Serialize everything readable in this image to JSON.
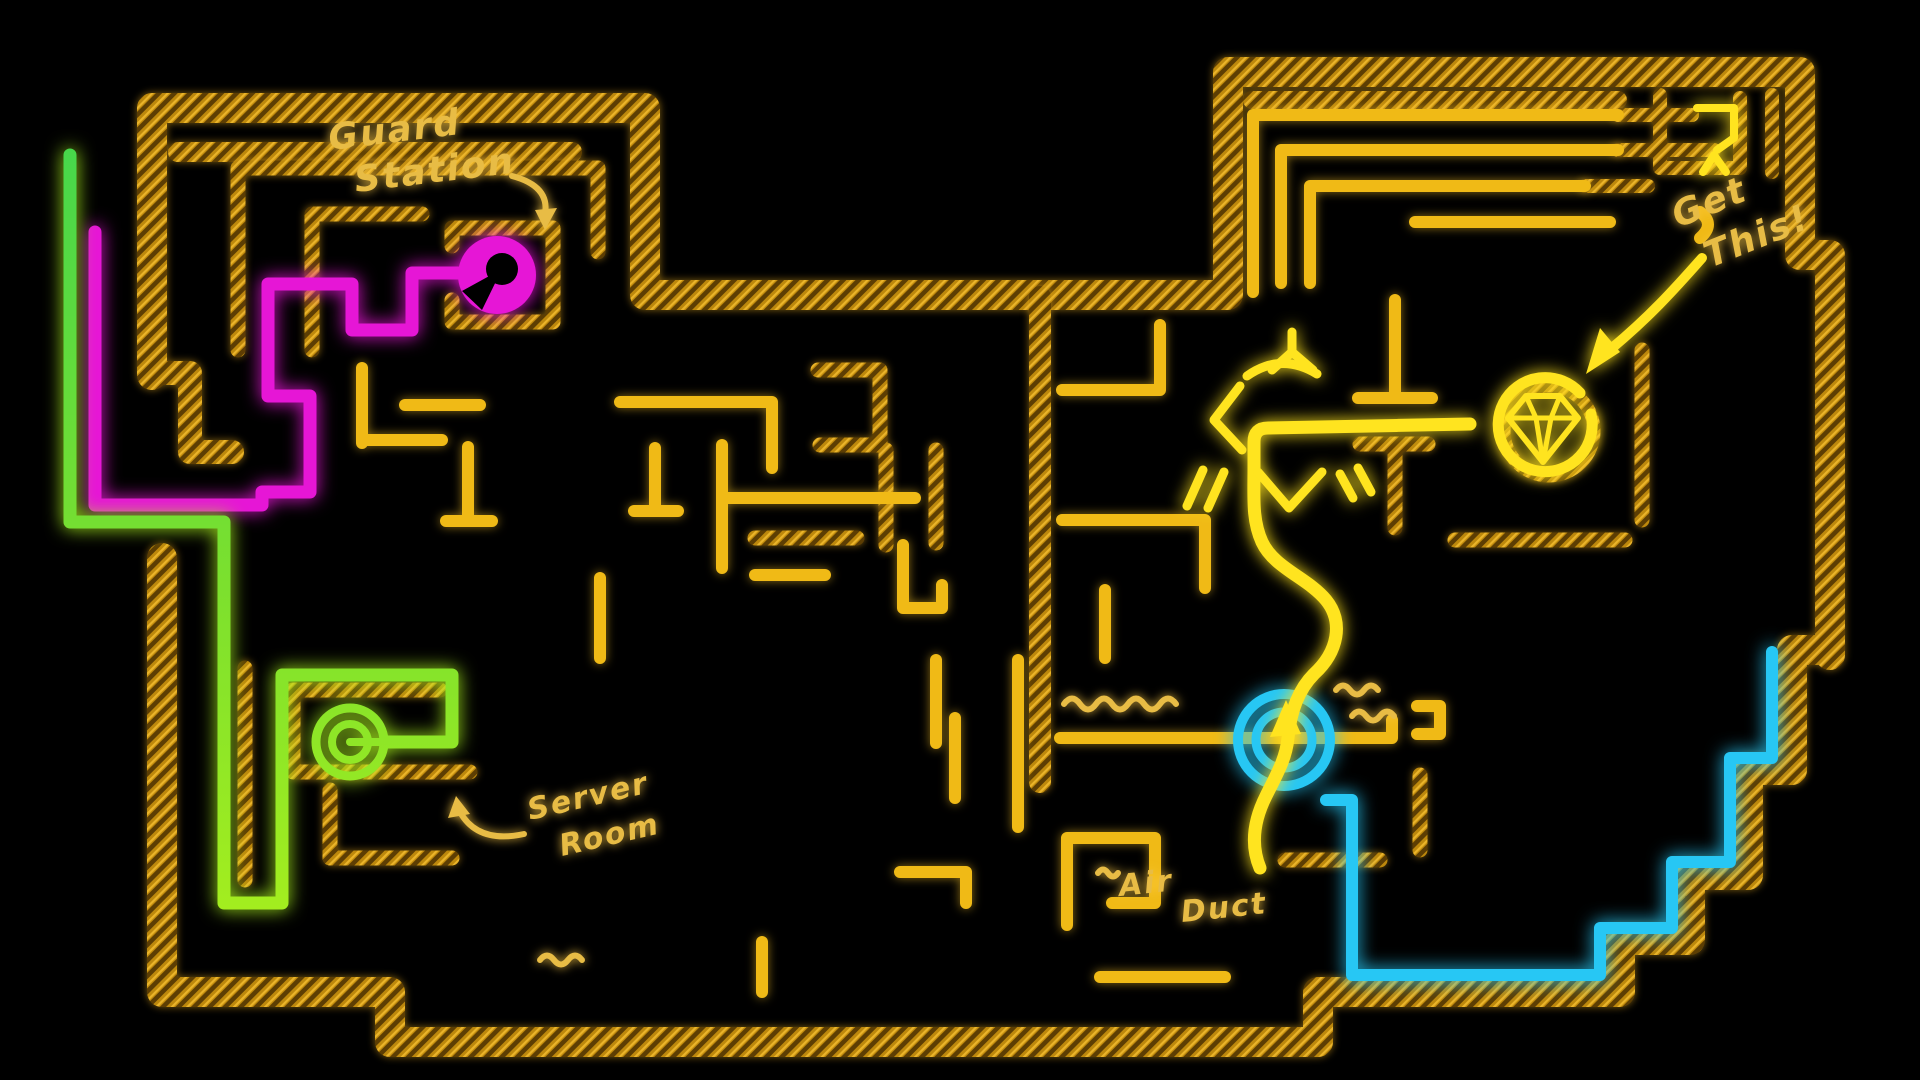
{
  "scene": {
    "description": "Hand-drawn neon heist blueprint maze on black background",
    "background": "#000000"
  },
  "colors": {
    "wall_gold": "#bd880c",
    "wall_gold_dark": "#5d3e03",
    "wall_gold_light": "#eab42a",
    "line_bright": "#f0ba16",
    "label_gold": "#e8bc45",
    "route_magenta": "#e616d6",
    "route_green_top": "#46d74b",
    "route_green_mid": "#7ce02e",
    "route_green": "#a8ef1d",
    "route_cyan": "#27c7f4",
    "route_yellow": "#ffe41f"
  },
  "labels": {
    "guard_station": {
      "line1": "Guard",
      "line2": "Station"
    },
    "server_room": {
      "line1": "Server",
      "line2": "Room"
    },
    "air_duct": {
      "line1": "Air",
      "line2": "Duct"
    },
    "get_this": {
      "line1": "Get",
      "line2": "This!"
    }
  },
  "markers": [
    {
      "name": "guard-station",
      "color": "#e616d6",
      "shape": "spiral-circle"
    },
    {
      "name": "server-room",
      "color": "#a8ef1d",
      "shape": "double-ring"
    },
    {
      "name": "air-duct",
      "color": "#27c7f4",
      "shape": "double-ring"
    },
    {
      "name": "gem-target",
      "color": "#ffe41f",
      "shape": "diamond-in-arrow-circle"
    }
  ]
}
